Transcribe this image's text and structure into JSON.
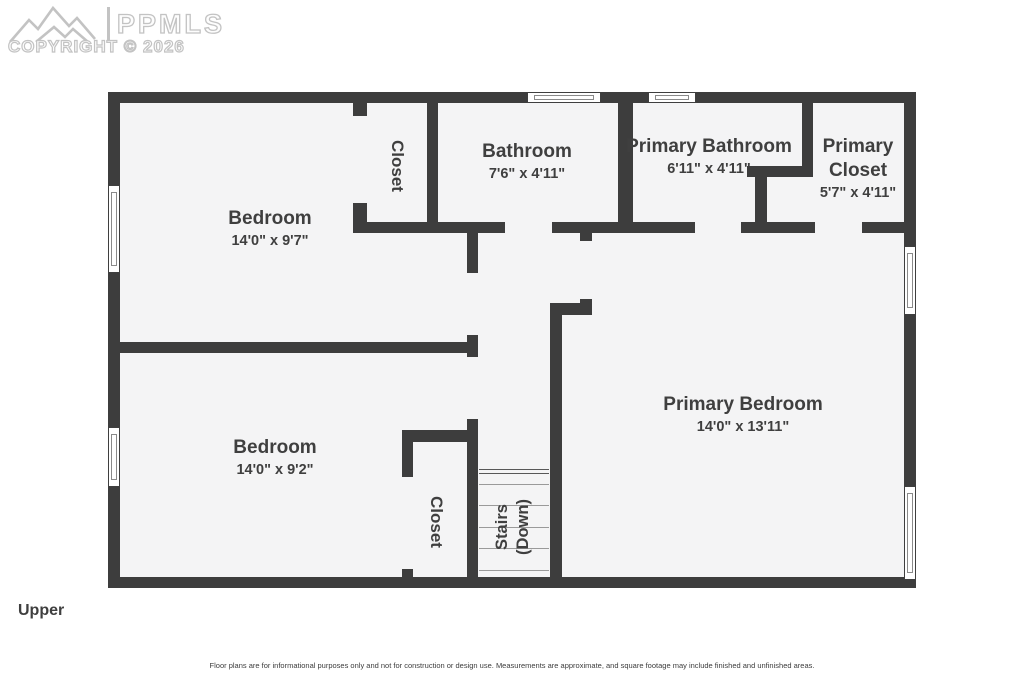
{
  "watermark": {
    "brand": "PPMLS",
    "copyright": "COPYRIGHT © 2026"
  },
  "floor_label": "Upper",
  "disclaimer": "Floor plans are for informational purposes only and not for construction or design use. Measurements are approximate, and square footage may include finished and unfinished areas.",
  "rooms": {
    "bedroom_top": {
      "name": "Bedroom",
      "dims": "14'0\" x 9'7\""
    },
    "closet_top": {
      "name": "Closet"
    },
    "bathroom": {
      "name": "Bathroom",
      "dims": "7'6\" x 4'11\""
    },
    "primary_bathroom": {
      "name": "Primary Bathroom",
      "dims": "6'11\" x 4'11\""
    },
    "primary_closet": {
      "name": "Primary Closet",
      "dims": "5'7\" x 4'11\""
    },
    "bedroom_bottom": {
      "name": "Bedroom",
      "dims": "14'0\" x 9'2\""
    },
    "closet_bottom": {
      "name": "Closet"
    },
    "primary_bedroom": {
      "name": "Primary Bedroom",
      "dims": "14'0\" x 13'11\""
    },
    "stairs": {
      "line1": "Stairs",
      "line2": "(Down)"
    }
  },
  "colors": {
    "wall": "#3d3d3d",
    "fill": "#f4f4f5",
    "label": "#3f3f3f",
    "wm": "#c3c3c3",
    "step": "#9a9a9a"
  }
}
